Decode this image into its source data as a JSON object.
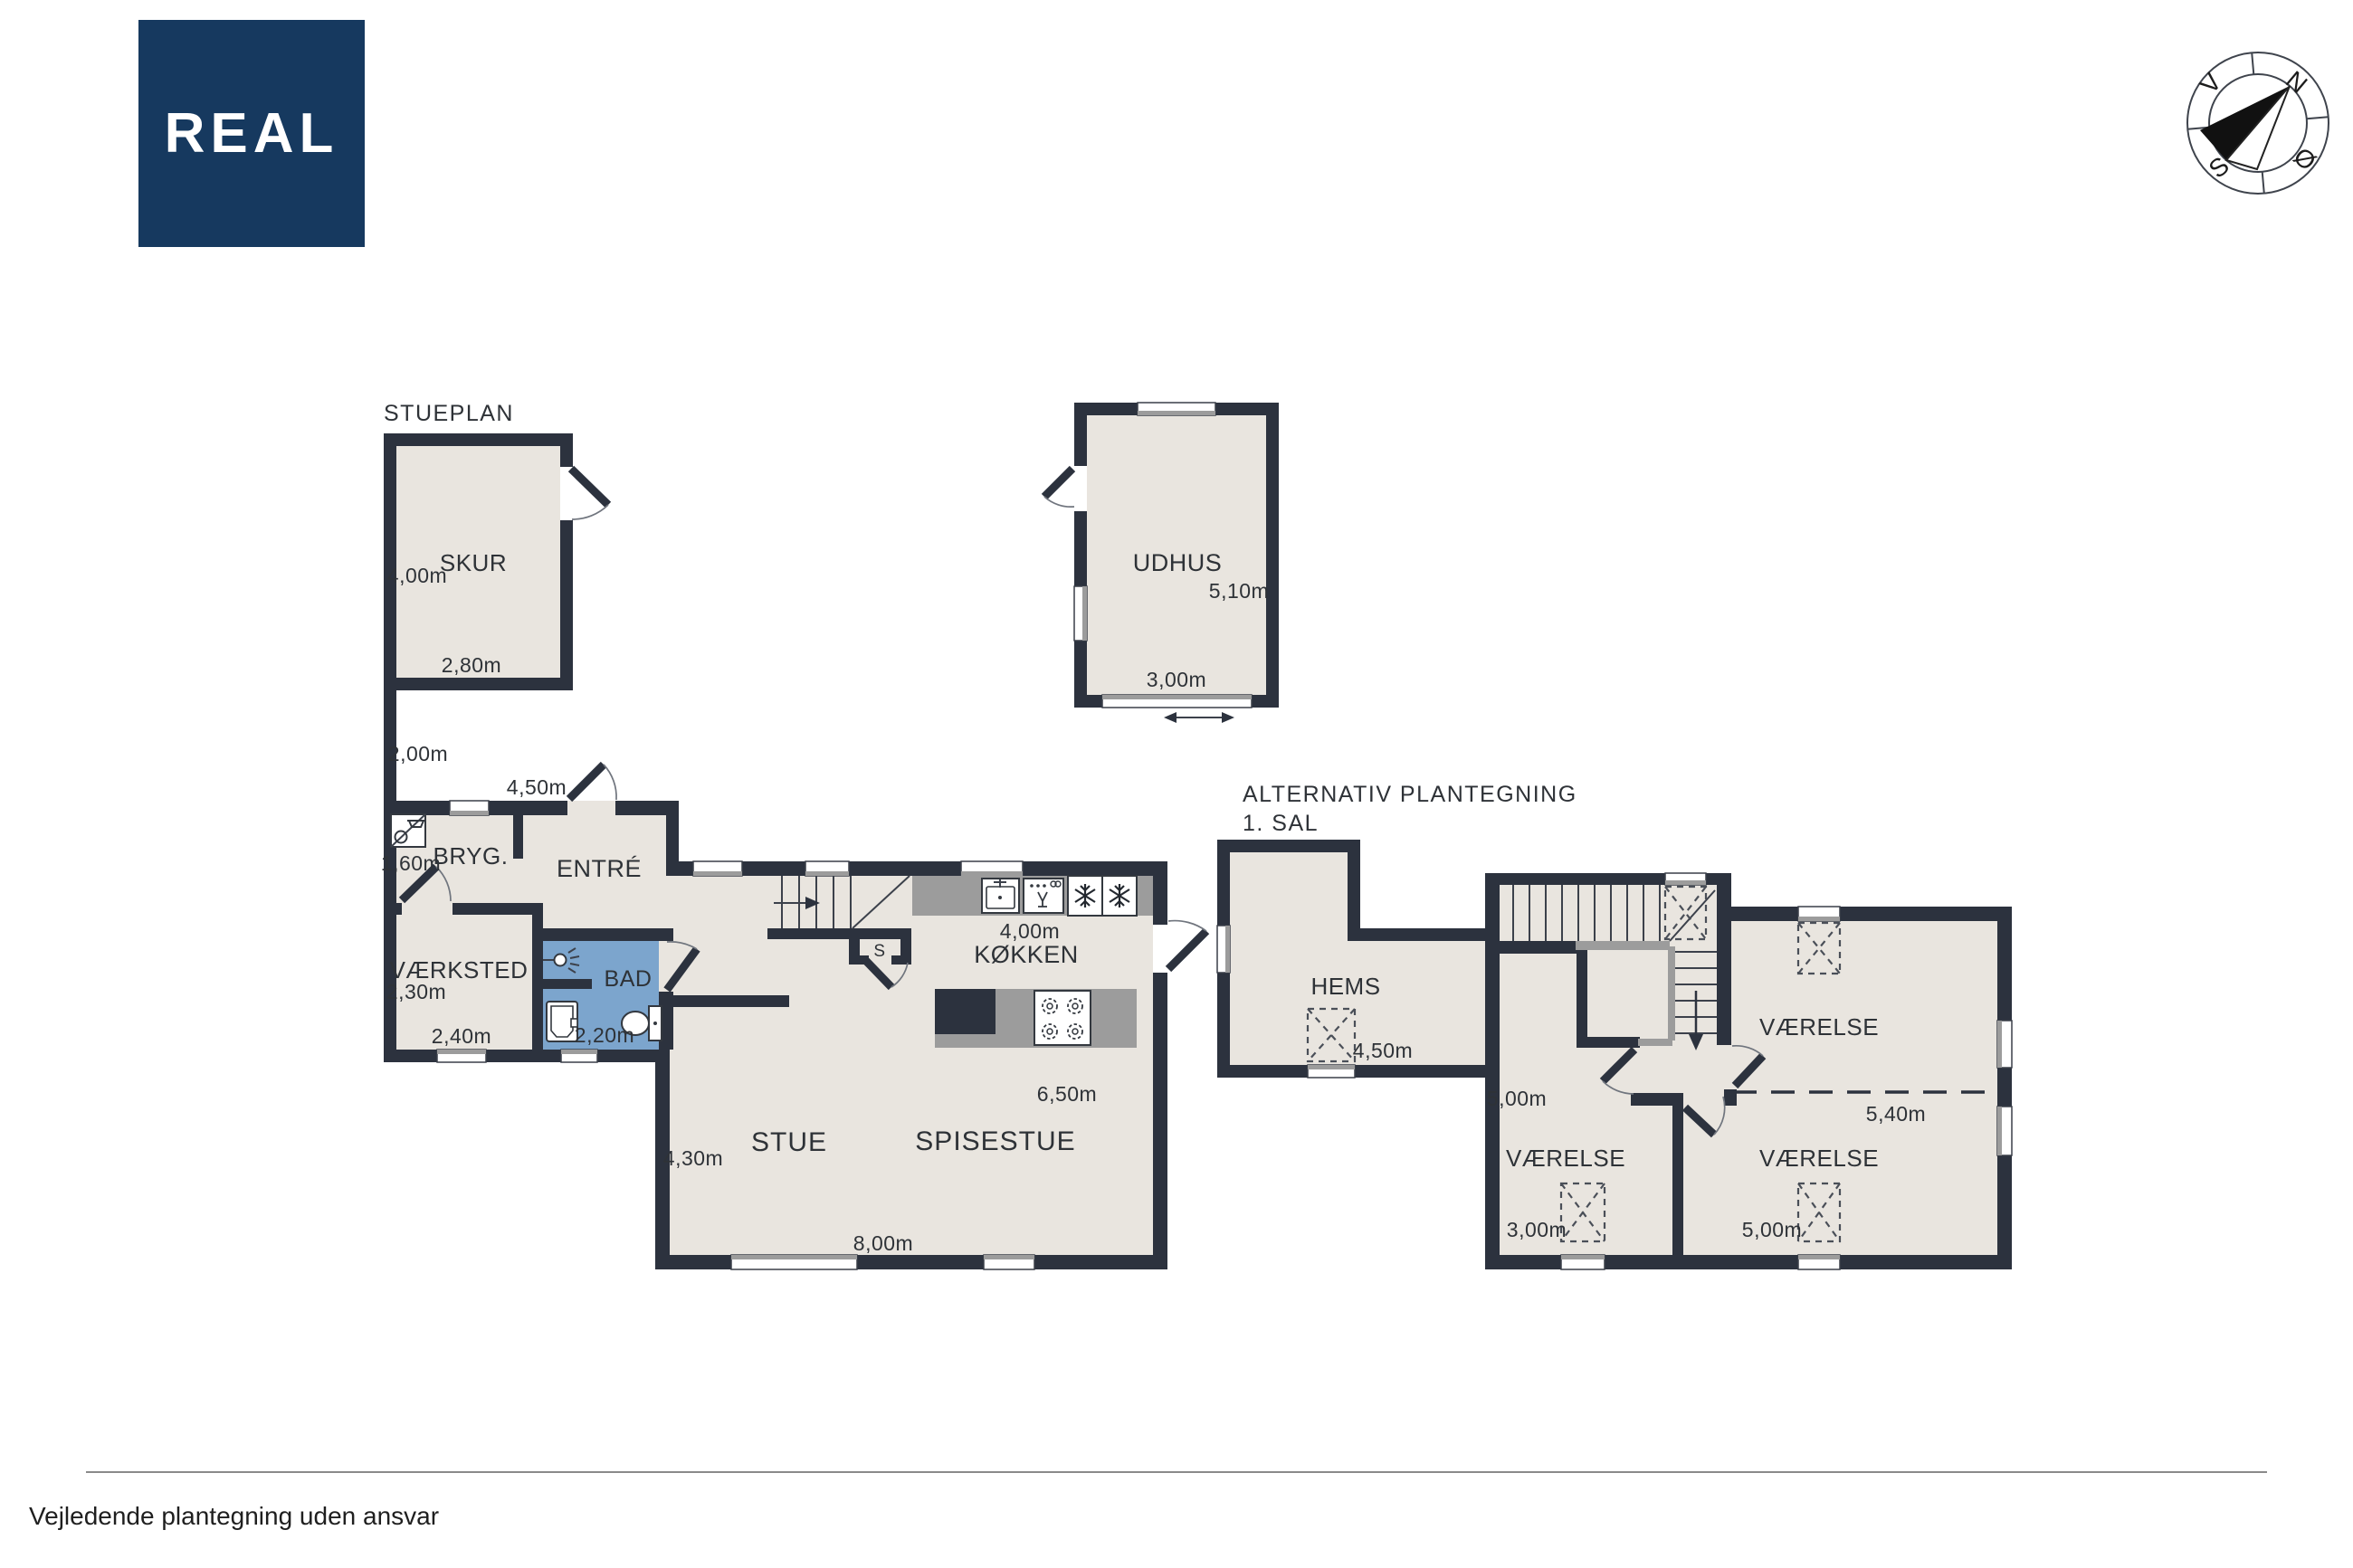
{
  "colors": {
    "wall": "#2c323e",
    "floor": "#e9e5df",
    "bathroom": "#7ca5cd",
    "counter_gray": "#9c9c9c",
    "logo_background": "#16395f",
    "logo_text": "#ffffff",
    "label_text": "#2e3237",
    "footer_rule": "#8a8a8a"
  },
  "logo": {
    "text": "REAL"
  },
  "compass": {
    "north": "N",
    "west": "V",
    "south": "S",
    "east": "Ø"
  },
  "stueplan": {
    "title": "STUEPLAN",
    "skur": {
      "name": "SKUR",
      "height": "4,00m",
      "width": "2,80m"
    },
    "passage_width": "2,00m",
    "entre": {
      "name": "ENTRÉ",
      "width": "4,50m"
    },
    "bryg": {
      "name": "BRYG.",
      "width": "1,60m"
    },
    "vaerksted": {
      "name": "VÆRKSTED",
      "height": "2,30m",
      "width": "2,40m"
    },
    "bad": {
      "name": "BAD",
      "width": "2,20m"
    },
    "koekken": {
      "name": "KØKKEN",
      "width": "4,00m"
    },
    "stue": {
      "name": "STUE",
      "height": "4,30m"
    },
    "spisestue": {
      "name": "SPISESTUE",
      "height": "6,50m",
      "width": "8,00m"
    },
    "stair_closet_label": "S",
    "udhus": {
      "name": "UDHUS",
      "height": "5,10m",
      "width": "3,00m"
    }
  },
  "first_floor": {
    "title": "ALTERNATIV PLANTEGNING",
    "subtitle": "1. SAL",
    "hems": {
      "name": "HEMS",
      "width": "4,50m"
    },
    "room_left": {
      "name": "VÆRELSE",
      "height": "5,00m",
      "width": "3,00m"
    },
    "room_top_right": {
      "name": "VÆRELSE",
      "dim": "5,40m"
    },
    "room_bottom_right": {
      "name": "VÆRELSE",
      "width": "5,00m"
    }
  },
  "footer": {
    "disclaimer": "Vejledende plantegning uden ansvar"
  }
}
